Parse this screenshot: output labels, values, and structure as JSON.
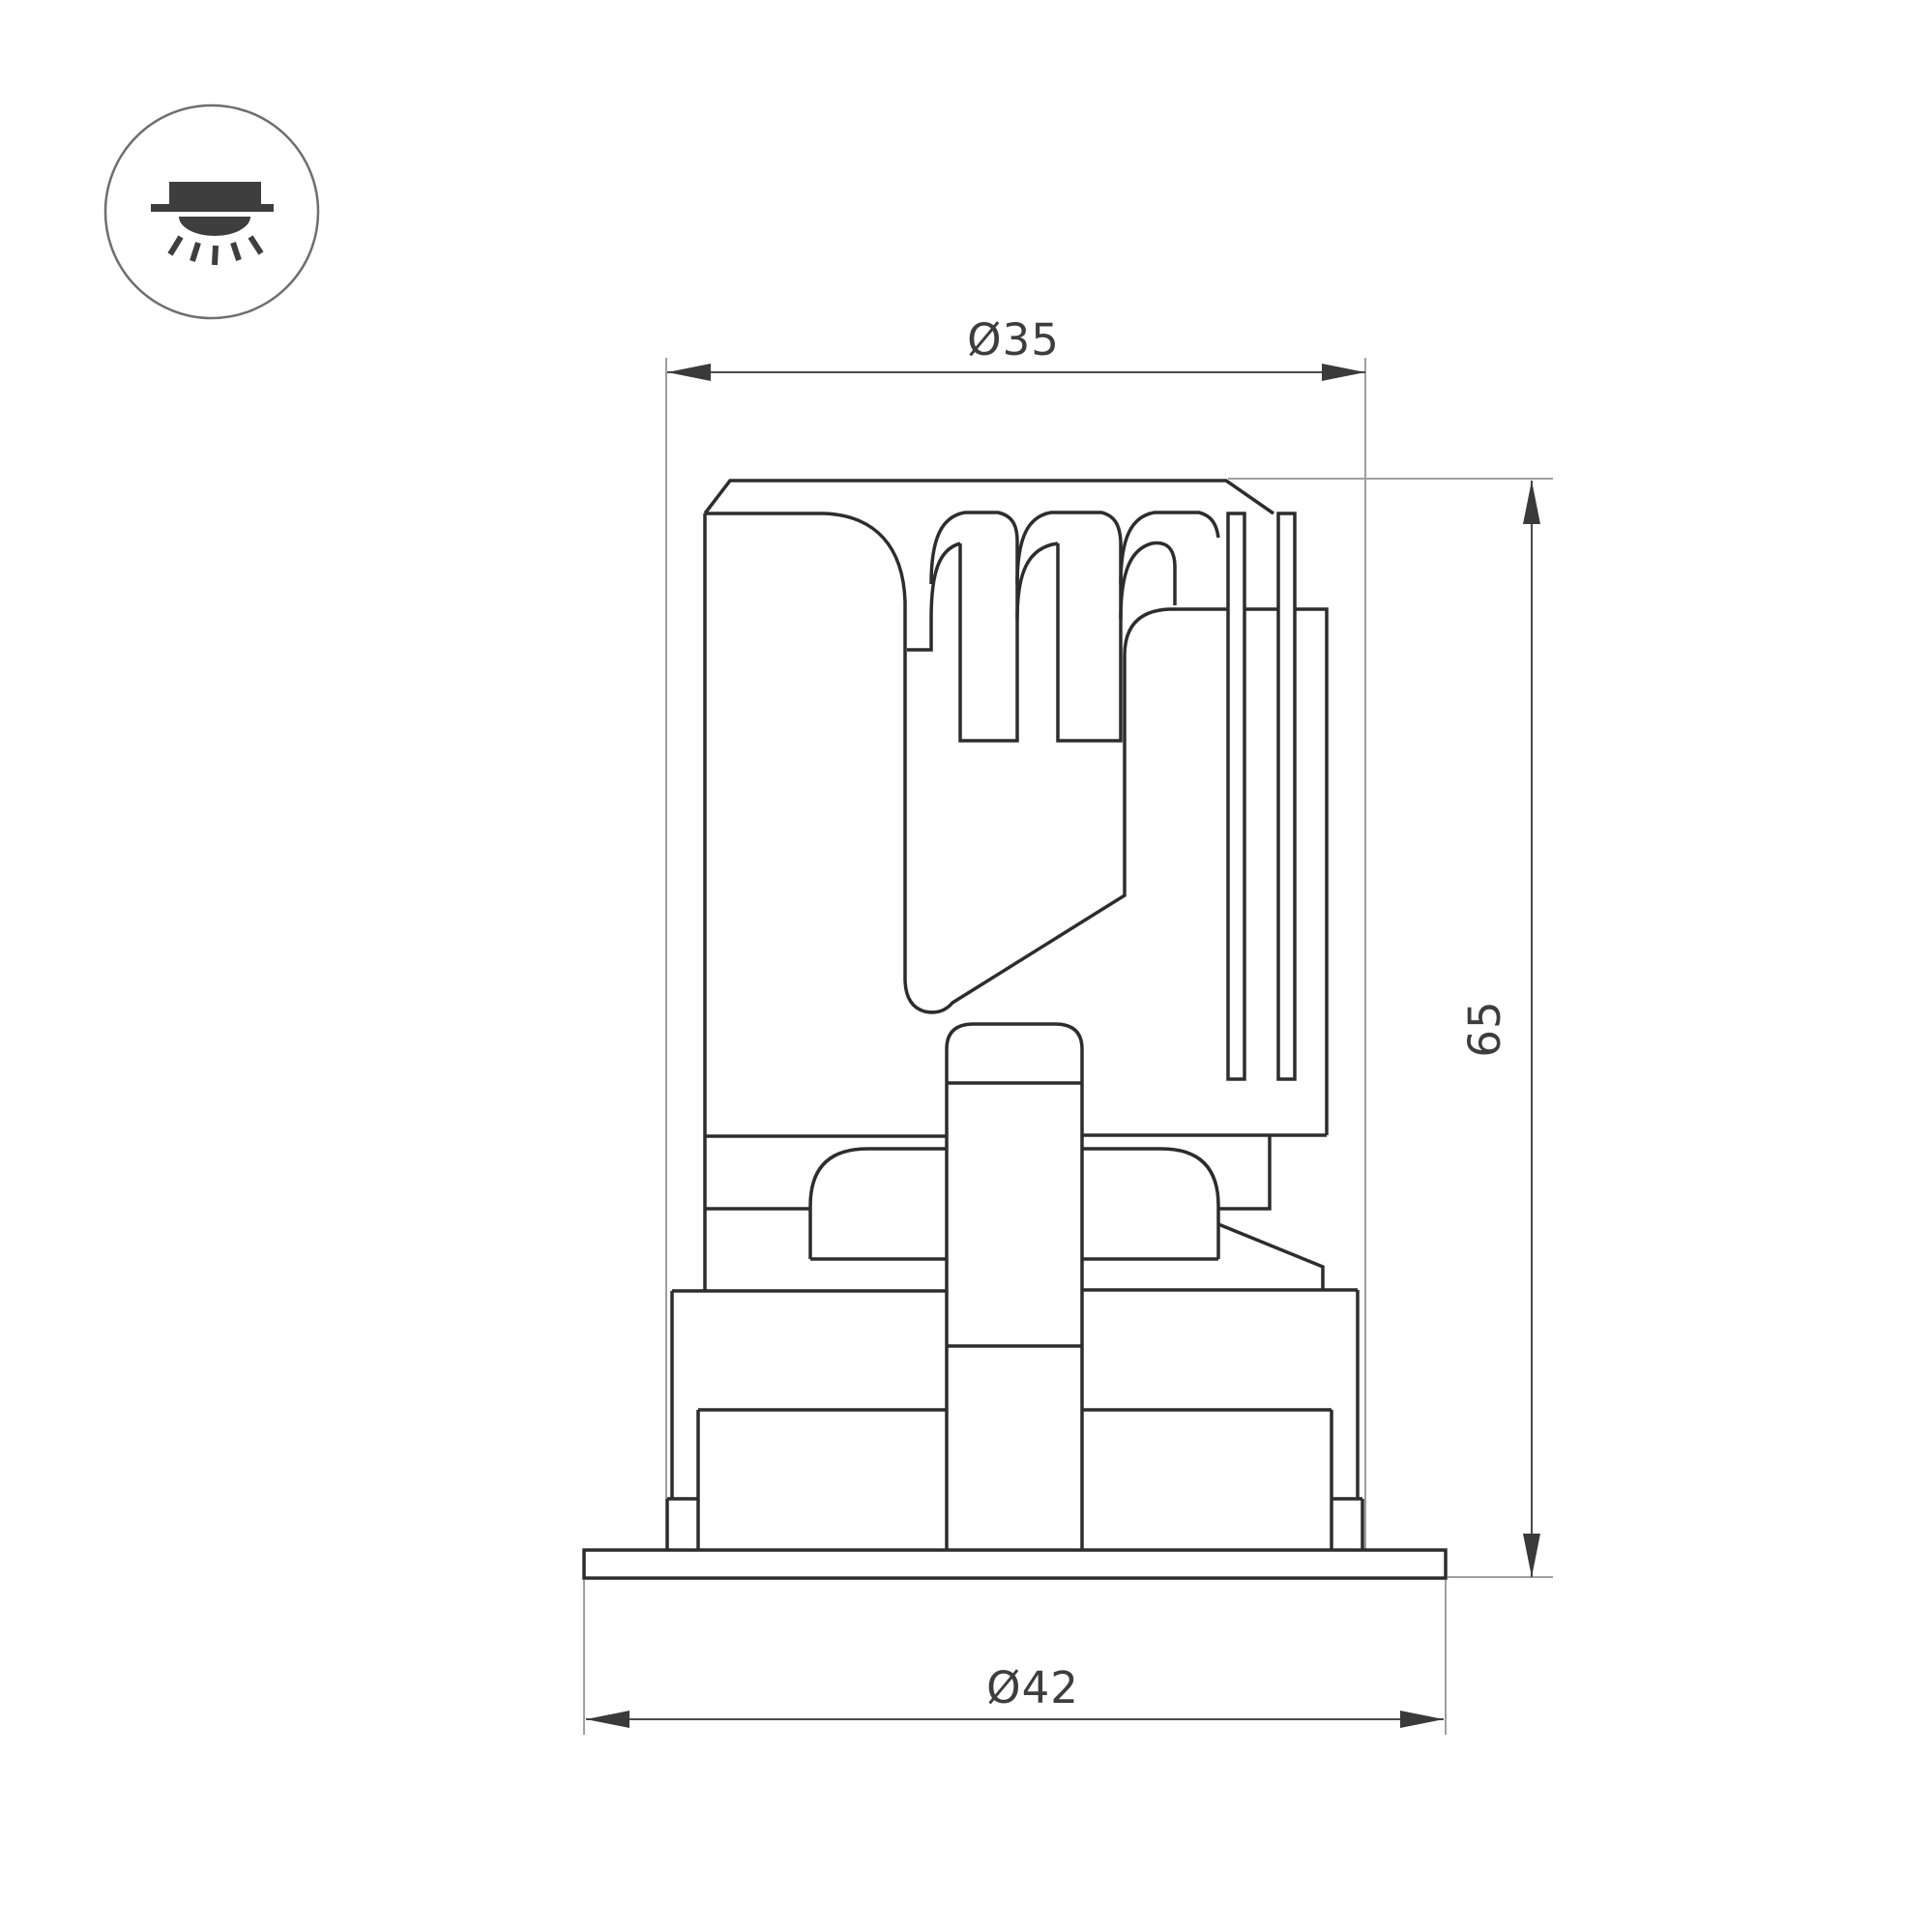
{
  "diagram": {
    "kind": "recessed-downlight-dimension-drawing",
    "dimensions": {
      "top_diameter": {
        "label": "Ø35"
      },
      "height": {
        "label": "65"
      },
      "flange_diameter": {
        "label": "Ø42"
      }
    },
    "icon": {
      "name": "recessed-downlight-icon"
    },
    "colors": {
      "background": "#ffffff",
      "drawing_line": "#2d2d2d",
      "dimension_line": "#4a4a4a",
      "extension_line": "#9f9f9f",
      "text": "#3d3d3d",
      "icon_glyph": "#3e3e3e",
      "icon_circle_stroke": "#6e6e6e"
    }
  }
}
